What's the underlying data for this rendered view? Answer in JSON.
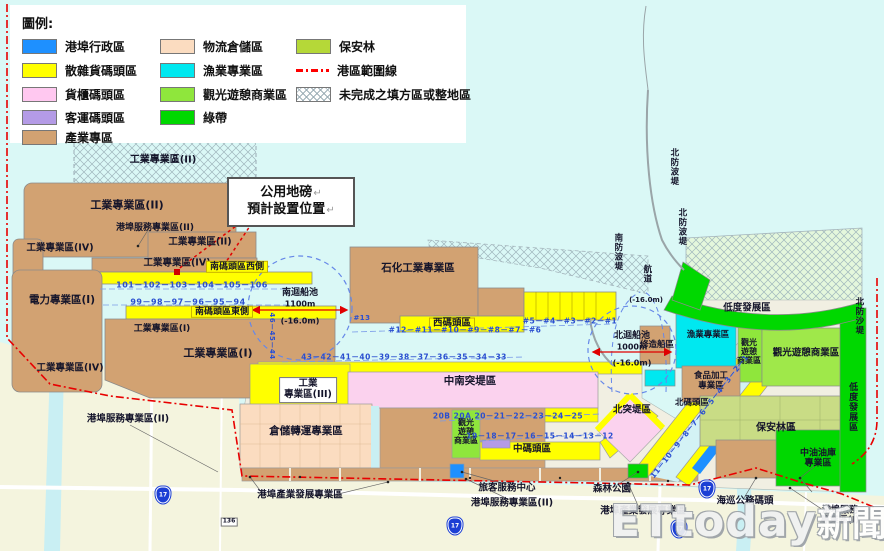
{
  "legend": {
    "title": "圖例:",
    "items": [
      {
        "label": "港埠行政區",
        "color": "#1E90FF",
        "type": "fill"
      },
      {
        "label": "散雜貨碼頭區",
        "color": "#FFFF00",
        "type": "fill"
      },
      {
        "label": "貨櫃碼頭區",
        "color": "#FFC8F0",
        "type": "fill"
      },
      {
        "label": "客運碼頭區",
        "color": "#B49BE6",
        "type": "fill"
      },
      {
        "label": "產業專區",
        "color": "#D2A272",
        "type": "fill"
      },
      {
        "label": "物流倉儲區",
        "color": "#FBDCC0",
        "type": "fill"
      },
      {
        "label": "漁業專業區",
        "color": "#00E8F0",
        "type": "fill"
      },
      {
        "label": "觀光遊憩商業區",
        "color": "#8FE63C",
        "type": "fill"
      },
      {
        "label": "綠帶",
        "color": "#00D800",
        "type": "fill"
      },
      {
        "label": "保安林",
        "color": "#B5D838",
        "type": "fill"
      },
      {
        "label": "港區範圍線",
        "color": "#FF0000",
        "type": "line"
      },
      {
        "label": "未完成之填方區或整地區",
        "color": "#9FB0B8",
        "type": "hatch"
      }
    ]
  },
  "callout": {
    "line1": "公用地磅",
    "line2": "預計設置位置",
    "return_mark": "↵"
  },
  "watermark": {
    "brand": "ETtoday",
    "suffix": "新聞雲"
  },
  "basins": {
    "south": {
      "name": "南迴船池",
      "width": "1100m",
      "depth": "(-16.0m)"
    },
    "north": {
      "name": "北迴船池",
      "width": "1000m",
      "depth": "(-16.0m)"
    },
    "channel": {
      "name": "航道",
      "depth": "(-16.0m)"
    }
  },
  "zones": {
    "ind2_hatch": "工業專業區(II)",
    "ind2_main": "工業專業區(II)",
    "port_service2_a": "港埠服務專業區(II)",
    "ind4_a": "工業專業區(IV)",
    "ind2_b": "工業專業區(II)",
    "ind4_b": "工業專業區(IV)",
    "south_wharf_west": "南碼頭區西側",
    "power1": "電力專業區(I)",
    "south_wharf_east": "南碼頭區東側",
    "ind1_a": "工業專業區(I)",
    "ind1_b": "工業專業區(I)",
    "ind4_c": "工業專業區(IV)",
    "port_service2_b": "港埠服務專業區(II)",
    "petrochem": "石化工業專業區",
    "west_wharf": "西碼頭區",
    "mid_south_pier": "中南突堤區",
    "ind3": "工業\n專業區(III)",
    "warehouse": "倉儲轉運專業區",
    "north_pier": "北突堤區",
    "shipyard": "修造船區",
    "fishery": "漁業專業區",
    "tourism_small": "觀光\n遊憩\n商業區",
    "tourism_big": "觀光遊憩商業區",
    "food_processing": "食品加工\n專業區",
    "north_wharf": "北碼頭區",
    "forest_reserve": "保安林區",
    "low_dev": "低度發展區",
    "north_sand_dike": "北防沙堤",
    "north_breakwater": "北防波堤",
    "south_breakwater": "南防波堤",
    "tourism_center": "觀光\n遊憩\n商業區",
    "mid_wharf": "中碼頭區",
    "passenger_center": "旅客服務中心",
    "port_service2_c": "港埠服務專業區(II)",
    "forest_park": "森林公園",
    "port_industry_dev": "港埠產業發展專業區",
    "coast_guard": "海巡公務碼頭",
    "port_service1": "港埠服務\n專業區(I)",
    "cpc_depot": "中油油庫\n專業區"
  },
  "berths": {
    "south_west": "101－102－103－104－105－106",
    "south_east": "99－98－97－96－95－94",
    "corner": "46－45－44",
    "west_13": "#13",
    "west_main": "#12－#11－#10－#9－#8－#7－#6",
    "west_low": "#5－#4－#3－#2－#1",
    "mid": "43－42－41－40－39－38－37－36－35－34－33",
    "mid_south": "20B 20A 20－21－22－23－24－25",
    "mid_inner": "19－18－17－16－15－14－13－12",
    "north_diag": "11－10－9－8－7－6－5－4－3－2－1"
  },
  "roads": {
    "route_shield": "17",
    "road_no": "136"
  }
}
